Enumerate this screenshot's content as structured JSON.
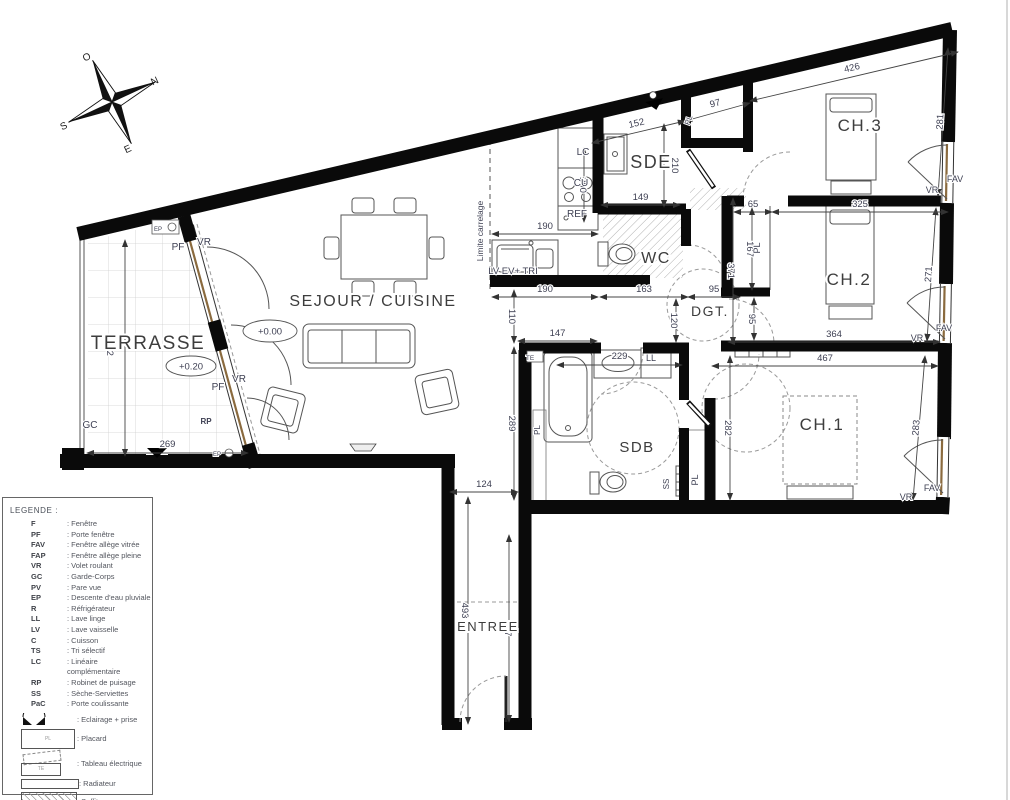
{
  "legend": {
    "title": "LEGENDE :",
    "entries": [
      {
        "abbr": "F",
        "label": ": Fenêtre"
      },
      {
        "abbr": "PF",
        "label": ": Porte fenêtre"
      },
      {
        "abbr": "FAV",
        "label": ": Fenêtre allège vitrée"
      },
      {
        "abbr": "FAP",
        "label": ": Fenêtre allège pleine"
      },
      {
        "abbr": "VR",
        "label": ": Volet roulant"
      },
      {
        "abbr": "GC",
        "label": ": Garde-Corps"
      },
      {
        "abbr": "PV",
        "label": ": Pare vue"
      },
      {
        "abbr": "EP",
        "label": ": Descente d'eau pluviale"
      },
      {
        "abbr": "R",
        "label": ": Réfrigérateur"
      },
      {
        "abbr": "LL",
        "label": ": Lave linge"
      },
      {
        "abbr": "LV",
        "label": ": Lave vaisselle"
      },
      {
        "abbr": "C",
        "label": ": Cuisson"
      },
      {
        "abbr": "TS",
        "label": ": Tri sélectif"
      },
      {
        "abbr": "LC",
        "label": ": Linéaire complémentaire"
      },
      {
        "abbr": "RP",
        "label": ": Robinet de puisage"
      },
      {
        "abbr": "SS",
        "label": ": Sèche-Serviettes"
      },
      {
        "abbr": "PaC",
        "label": ": Porte coulissante"
      }
    ],
    "symbols": [
      {
        "icon": "eclairage-icon",
        "label": ": Eclairage + prise"
      },
      {
        "icon": "placard-icon",
        "label": ": Placard"
      },
      {
        "icon": "tableau-electrique-icon",
        "label": ": Tableau électrique"
      },
      {
        "icon": "radiateur-icon",
        "label": ": Radiateur"
      },
      {
        "icon": "soffite-icon",
        "label": ": Soffite\nFaux-plafond"
      }
    ]
  },
  "compass": {
    "letters": [
      {
        "t": "O",
        "x": 88,
        "y": 60
      },
      {
        "t": "N",
        "x": 156,
        "y": 84
      },
      {
        "t": "S",
        "x": 65,
        "y": 129
      },
      {
        "t": "E",
        "x": 129,
        "y": 152
      }
    ]
  },
  "plan": {
    "rooms": [
      {
        "t": "TERRASSE",
        "x": 148,
        "y": 349,
        "size": 19
      },
      {
        "t": "SEJOUR / CUISINE",
        "x": 373,
        "y": 306,
        "size": 16
      },
      {
        "t": "SDE",
        "x": 651,
        "y": 168,
        "size": 18
      },
      {
        "t": "WC",
        "x": 656,
        "y": 263,
        "size": 16
      },
      {
        "t": "DGT.",
        "x": 710,
        "y": 316,
        "size": 14
      },
      {
        "t": "CH.3",
        "x": 860,
        "y": 131,
        "size": 17
      },
      {
        "t": "CH.2",
        "x": 849,
        "y": 285,
        "size": 17
      },
      {
        "t": "CH.1",
        "x": 822,
        "y": 430,
        "size": 17
      },
      {
        "t": "SDB",
        "x": 637,
        "y": 452,
        "size": 15
      },
      {
        "t": "ENTREE",
        "x": 488,
        "y": 631,
        "size": 13
      }
    ],
    "levels": [
      {
        "t": "+0.00",
        "x": 270,
        "y": 331,
        "rx": 27,
        "ry": 11
      },
      {
        "t": "+0.20",
        "x": 191,
        "y": 366,
        "rx": 25,
        "ry": 10
      }
    ],
    "dimensions": [
      {
        "v": "426",
        "x1": 750,
        "y1": 101,
        "x2": 958,
        "y2": 52,
        "o": 6
      },
      {
        "v": "97",
        "x1": 685,
        "y1": 121,
        "x2": 750,
        "y2": 103,
        "o": 6
      },
      {
        "v": "152",
        "x1": 592,
        "y1": 143,
        "x2": 685,
        "y2": 121,
        "o": 6
      },
      {
        "v": "281",
        "x1": 948,
        "y1": 48,
        "x2": 938,
        "y2": 196,
        "o": 0
      },
      {
        "v": "271",
        "x1": 936,
        "y1": 208,
        "x2": 927,
        "y2": 341,
        "o": 0
      },
      {
        "v": "283",
        "x1": 925,
        "y1": 356,
        "x2": 913,
        "y2": 500,
        "o": 0
      },
      {
        "v": "210",
        "x1": 664,
        "y1": 124,
        "x2": 664,
        "y2": 207,
        "o": 8
      },
      {
        "v": "149",
        "x1": 601,
        "y1": 205,
        "x2": 680,
        "y2": 205,
        "o": 5
      },
      {
        "v": "200",
        "x1": 584,
        "y1": 148,
        "x2": 584,
        "y2": 222,
        "o": -4
      },
      {
        "v": "190",
        "x1": 492,
        "y1": 234,
        "x2": 598,
        "y2": 234,
        "o": 5
      },
      {
        "v": "190",
        "x1": 492,
        "y1": 297,
        "x2": 598,
        "y2": 297,
        "o": 5
      },
      {
        "v": "163",
        "x1": 600,
        "y1": 297,
        "x2": 688,
        "y2": 297,
        "o": 5
      },
      {
        "v": "95",
        "x1": 688,
        "y1": 297,
        "x2": 740,
        "y2": 297,
        "o": 5
      },
      {
        "v": "120",
        "x1": 676,
        "y1": 299,
        "x2": 676,
        "y2": 342,
        "o": -5
      },
      {
        "v": "110",
        "x1": 514,
        "y1": 290,
        "x2": 514,
        "y2": 343,
        "o": -5
      },
      {
        "v": "147",
        "x1": 518,
        "y1": 341,
        "x2": 597,
        "y2": 341,
        "o": 5
      },
      {
        "v": "229",
        "x1": 557,
        "y1": 365,
        "x2": 682,
        "y2": 365,
        "o": 6
      },
      {
        "v": "65",
        "x1": 734,
        "y1": 212,
        "x2": 772,
        "y2": 212,
        "o": 5
      },
      {
        "v": "325",
        "x1": 772,
        "y1": 212,
        "x2": 948,
        "y2": 212,
        "o": 5
      },
      {
        "v": "371",
        "x1": 733,
        "y1": 198,
        "x2": 733,
        "y2": 344,
        "o": -5
      },
      {
        "v": "167",
        "x1": 752,
        "y1": 208,
        "x2": 752,
        "y2": 290,
        "o": -5
      },
      {
        "v": "95",
        "x1": 754,
        "y1": 298,
        "x2": 754,
        "y2": 340,
        "o": -5
      },
      {
        "v": "364",
        "x1": 728,
        "y1": 342,
        "x2": 940,
        "y2": 342,
        "o": 5
      },
      {
        "v": "467",
        "x1": 712,
        "y1": 366,
        "x2": 938,
        "y2": 366,
        "o": 5
      },
      {
        "v": "282",
        "x1": 730,
        "y1": 356,
        "x2": 730,
        "y2": 500,
        "o": -5
      },
      {
        "v": "289",
        "x1": 514,
        "y1": 347,
        "x2": 514,
        "y2": 500,
        "o": -5
      },
      {
        "v": "402",
        "x1": 125,
        "y1": 240,
        "x2": 125,
        "y2": 456,
        "o": -18
      },
      {
        "v": "269",
        "x1": 87,
        "y1": 453,
        "x2": 248,
        "y2": 453,
        "o": 6
      },
      {
        "v": "124",
        "x1": 450,
        "y1": 492,
        "x2": 518,
        "y2": 492,
        "o": 5
      },
      {
        "v": "493",
        "x1": 468,
        "y1": 497,
        "x2": 468,
        "y2": 724,
        "o": -6
      },
      {
        "v": "407",
        "x1": 509,
        "y1": 535,
        "x2": 509,
        "y2": 722,
        "o": -4
      }
    ],
    "annotations": [
      {
        "t": "PF",
        "x": 178,
        "y": 250,
        "s": 10
      },
      {
        "t": "VR",
        "x": 204,
        "y": 245,
        "s": 10
      },
      {
        "t": "PF",
        "x": 218,
        "y": 390,
        "s": 10
      },
      {
        "t": "VR",
        "x": 239,
        "y": 382,
        "s": 10
      },
      {
        "t": "GC",
        "x": 90,
        "y": 428,
        "s": 10
      },
      {
        "t": "RP",
        "x": 206,
        "y": 424,
        "s": 8,
        "b": 1
      },
      {
        "t": "EP",
        "x": 158,
        "y": 231,
        "s": 6
      },
      {
        "t": "EP",
        "x": 217,
        "y": 456,
        "s": 6
      },
      {
        "t": "Limite carrelage",
        "x": 483,
        "y": 231,
        "r": -90,
        "s": 8.5
      },
      {
        "t": "LC",
        "x": 583,
        "y": 155,
        "s": 10
      },
      {
        "t": "CU",
        "x": 581,
        "y": 186,
        "s": 10
      },
      {
        "t": "REF",
        "x": 577,
        "y": 217,
        "s": 10
      },
      {
        "t": "LV EV+ TRI",
        "x": 513,
        "y": 274,
        "s": 9.5
      },
      {
        "t": "LL",
        "x": 651,
        "y": 361,
        "s": 9
      },
      {
        "t": "TE",
        "x": 530,
        "y": 360,
        "s": 6.5
      },
      {
        "t": "PL",
        "x": 540,
        "y": 430,
        "r": -90,
        "s": 8
      },
      {
        "t": "PL",
        "x": 698,
        "y": 480,
        "r": -90,
        "s": 9
      },
      {
        "t": "SS",
        "x": 669,
        "y": 484,
        "r": -90,
        "s": 8
      },
      {
        "t": "PL",
        "x": 691,
        "y": 121,
        "r": -70,
        "s": 8
      },
      {
        "t": "PL",
        "x": 760,
        "y": 248,
        "r": -90,
        "s": 9
      },
      {
        "t": "FAV",
        "x": 955,
        "y": 182,
        "s": 9
      },
      {
        "t": "VR",
        "x": 932,
        "y": 193,
        "s": 9
      },
      {
        "t": "FAV",
        "x": 944,
        "y": 331,
        "s": 9
      },
      {
        "t": "VR",
        "x": 917,
        "y": 341,
        "s": 9
      },
      {
        "t": "FAV",
        "x": 932,
        "y": 491,
        "s": 9
      },
      {
        "t": "VR",
        "x": 906,
        "y": 500,
        "s": 9
      }
    ]
  }
}
